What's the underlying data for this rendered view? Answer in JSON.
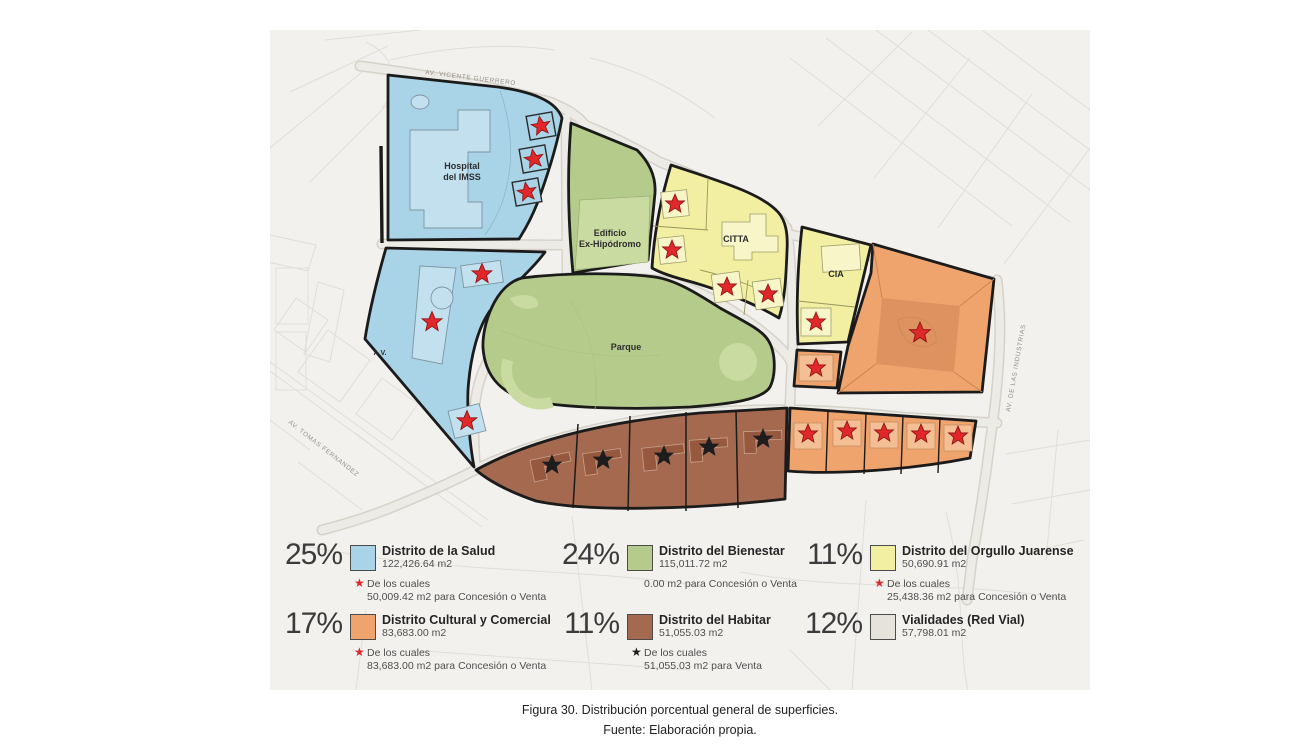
{
  "colors": {
    "page_bg": "#ffffff",
    "map_bg": "#f3f1ee",
    "faint_street": "#e1ded8",
    "road_edge": "#d6d2ca",
    "road_fill": "#edebe5",
    "outline": "#1b1b1b",
    "salud": "#a9d3e6",
    "salud_light": "#c2e0ee",
    "bienestar": "#b4cb8b",
    "bienestar_light": "#c9dba0",
    "orgullo": "#f2efa2",
    "orgullo_light": "#f8f6c8",
    "cultural": "#efa46e",
    "cultural_dark": "#dd9260",
    "cultural_light": "#f4bf94",
    "habitar": "#a56950",
    "habitar_dark": "#96593f",
    "vialidades": "#e6e3dd",
    "star_red": "#e0282b",
    "star_black": "#1d1d1d",
    "label_gray": "#94908a",
    "text_dark": "#333333",
    "text_mid": "#555555"
  },
  "icons": {
    "star": "★"
  },
  "map": {
    "streets": {
      "vicente": "AV. VICENTE GUERRERO",
      "tomas": "AV. TOMAS FERNANDEZ",
      "industrias": "AV. DE LAS INDUSTRIAS"
    },
    "areas": {
      "hospital_line1": "Hospital",
      "hospital_line2": "del IMSS",
      "exhipodromo_line1": "Edificio",
      "exhipodromo_line2": "Ex-Hipódromo",
      "citta": "CITTA",
      "cia": "CIA",
      "parque": "Parque",
      "av": "A.V."
    }
  },
  "legend": {
    "items": [
      {
        "percent": "25%",
        "name": "Distrito de la Salud",
        "area": "122,426.64 m2",
        "note_star": "red",
        "note_line1": "De los cuales",
        "note_line2": "50,009.42 m2 para Concesión o Venta",
        "color_key": "salud"
      },
      {
        "percent": "24%",
        "name": "Distrito del Bienestar",
        "area": "115,011.72 m2",
        "note_star": "",
        "note_line1": "0.00 m2 para Concesión o Venta",
        "note_line2": "",
        "color_key": "bienestar"
      },
      {
        "percent": "11%",
        "name": "Distrito del Orgullo Juarense",
        "area": "50,690.91 m2",
        "note_star": "red",
        "note_line1": "De los cuales",
        "note_line2": "25,438.36 m2 para Concesión o Venta",
        "color_key": "orgullo"
      },
      {
        "percent": "17%",
        "name": "Distrito Cultural y Comercial",
        "area": "83,683.00 m2",
        "note_star": "red",
        "note_line1": "De los cuales",
        "note_line2": "83,683.00 m2 para Concesión o Venta",
        "color_key": "cultural"
      },
      {
        "percent": "11%",
        "name": "Distrito del Habitar",
        "area": "51,055.03 m2",
        "note_star": "black",
        "note_line1": "De los cuales",
        "note_line2": "51,055.03 m2 para Venta",
        "color_key": "habitar"
      },
      {
        "percent": "12%",
        "name": "Vialidades (Red Vial)",
        "area": "57,798.01 m2",
        "note_star": "",
        "note_line1": "",
        "note_line2": "",
        "color_key": "vialidades"
      }
    ]
  },
  "caption": {
    "line1": "Figura 30. Distribución porcentual general de superficies.",
    "line2": "Fuente: Elaboración propia."
  }
}
